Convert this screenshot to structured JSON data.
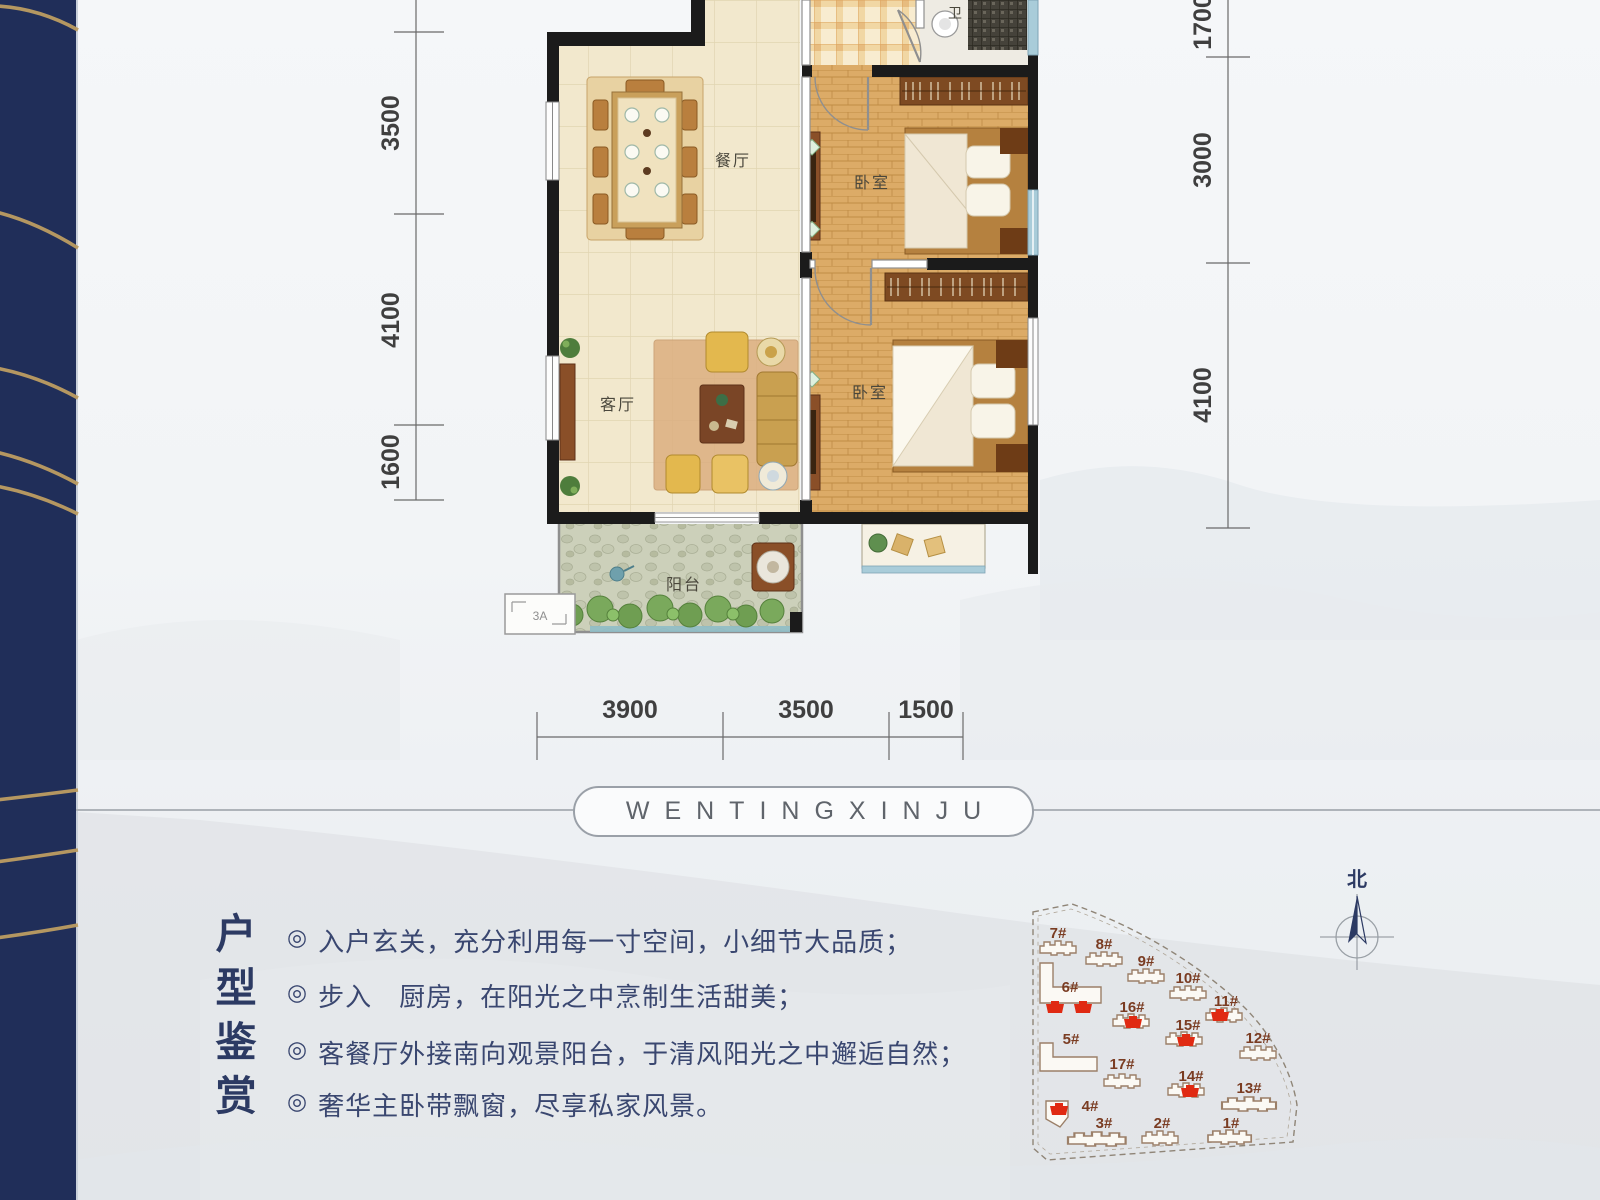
{
  "banner": {
    "text": "WENTINGXINJU"
  },
  "floor_plan": {
    "rooms": {
      "dining": "餐厅",
      "living": "客厅",
      "bedroom_top": "卧室",
      "bedroom_bottom": "卧室",
      "bathroom": "卫",
      "balcony": "阳台"
    },
    "ac_unit_label": "3A",
    "dimensions": {
      "left": [
        "3500",
        "4100",
        "1600"
      ],
      "right": [
        "1700",
        "3000",
        "4100"
      ],
      "bottom": [
        "3900",
        "3500",
        "1500"
      ]
    }
  },
  "appreciation": {
    "title": "户型鉴赏",
    "bullet_marker": "◎",
    "bullets": [
      "入户玄关，充分利用每一寸空间，小细节大品质；",
      "步入　厨房，在阳光之中烹制生活甜美；",
      "客餐厅外接南向观景阳台，于清风阳光之中邂逅自然；",
      "奢华主卧带飘窗，尽享私家风景。"
    ]
  },
  "site_plan": {
    "north_label": "北",
    "buildings": [
      {
        "label": "1#",
        "highlighted": false
      },
      {
        "label": "2#",
        "highlighted": false
      },
      {
        "label": "3#",
        "highlighted": false
      },
      {
        "label": "4#",
        "highlighted": true
      },
      {
        "label": "5#",
        "highlighted": false
      },
      {
        "label": "6#",
        "highlighted": true
      },
      {
        "label": "7#",
        "highlighted": false
      },
      {
        "label": "8#",
        "highlighted": false
      },
      {
        "label": "9#",
        "highlighted": false
      },
      {
        "label": "10#",
        "highlighted": false
      },
      {
        "label": "11#",
        "highlighted": true
      },
      {
        "label": "12#",
        "highlighted": false
      },
      {
        "label": "13#",
        "highlighted": false
      },
      {
        "label": "14#",
        "highlighted": true
      },
      {
        "label": "15#",
        "highlighted": true
      },
      {
        "label": "16#",
        "highlighted": true
      },
      {
        "label": "17#",
        "highlighted": false
      }
    ]
  },
  "colors": {
    "band_navy": "#202e59",
    "band_gold": "#bd9d62",
    "highlight_red": "#e02a12",
    "text_navy": "#2c3a63",
    "wall_black": "#1b1b1b"
  }
}
